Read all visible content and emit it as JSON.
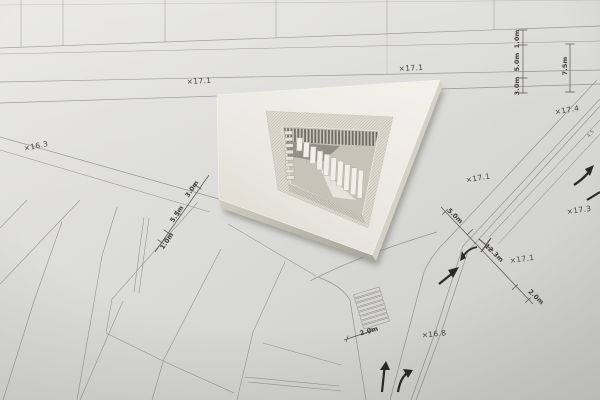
{
  "meta": {
    "scene_title": "Architectural massing model placed on printed site plan"
  },
  "colors": {
    "paper_light": "#e9e8e6",
    "paper_mid": "#dadad8",
    "paper_dark": "#c7c7c5",
    "plan_line": "#8f8c86",
    "dim_line": "#55524c",
    "arrow": "#2b2925",
    "model_top": "#ecebe3",
    "model_side": "#c2c0b5",
    "model_bevel": "#dbd8cd",
    "court_pit": "#c6c3b8",
    "court_dark": "#6b685f",
    "step_light": "#f1f0e8",
    "label_text": "#45433e"
  },
  "plan": {
    "spot_elevations": [
      {
        "text": "×16.3"
      },
      {
        "text": "×17.1"
      },
      {
        "text": "×17.1"
      },
      {
        "text": "×17.4"
      },
      {
        "text": "×17.1"
      },
      {
        "text": "×17.3"
      },
      {
        "text": "×17.1"
      },
      {
        "text": "×16.8"
      }
    ],
    "dimension_labels": [
      {
        "text": "1.0m"
      },
      {
        "text": "5.0m"
      },
      {
        "text": "3.0m"
      },
      {
        "text": "7.5m"
      },
      {
        "text": "3.0m"
      },
      {
        "text": "5.5m"
      },
      {
        "text": "1.0m"
      },
      {
        "text": "5.0m"
      },
      {
        "text": "12.3m"
      },
      {
        "text": "2.0m"
      },
      {
        "text": "2.0m"
      },
      {
        "text": "4.5"
      }
    ]
  }
}
